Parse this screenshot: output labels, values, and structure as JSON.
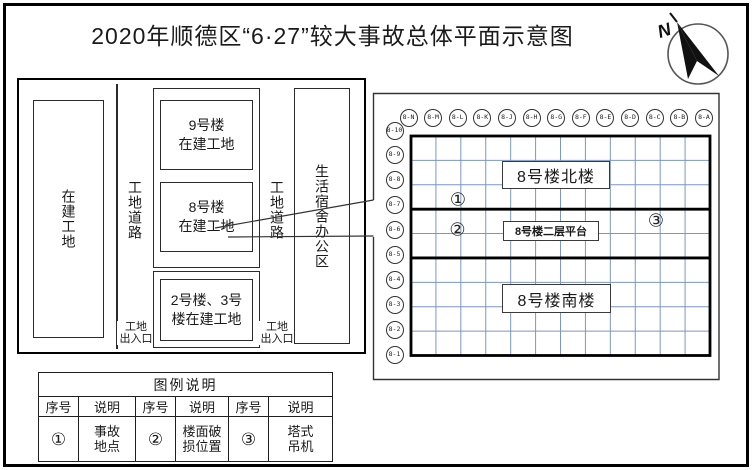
{
  "title": "2020年顺德区“6·27”较大事故总体平面示意图",
  "compass": {
    "label": "N"
  },
  "site_plan": {
    "left_area": "在建工地",
    "road_left": "工地道路",
    "road_right": "工地道路",
    "gate_left": "工地\n出入口",
    "gate_right": "工地\n出入口",
    "building9": "9号楼\n在建工地",
    "building8": "8号楼\n在建工地",
    "building23": "2号楼、3号\n楼在建工地",
    "living_area": "生活宿舍办公区"
  },
  "detail_plan": {
    "column_labels": [
      "8-N",
      "8-M",
      "8-L",
      "8-K",
      "8-J",
      "8-H",
      "8-G",
      "8-F",
      "8-E",
      "8-D",
      "8-C",
      "8-B",
      "8-A"
    ],
    "row_labels": [
      "8-10",
      "8-9",
      "8-8",
      "8-7",
      "8-6",
      "8-5",
      "8-4",
      "8-3",
      "8-2",
      "8-1"
    ],
    "north_building": "8号楼北楼",
    "platform": "8号楼二层平台",
    "south_building": "8号楼南楼",
    "markers": [
      {
        "symbol": "①"
      },
      {
        "symbol": "②"
      },
      {
        "symbol": "③"
      }
    ],
    "grid_color": "#7b96c8",
    "line_color": "#000000"
  },
  "legend": {
    "title": "图例说明",
    "header_row": [
      "序号",
      "说明",
      "序号",
      "说明",
      "序号",
      "说明"
    ],
    "value_row": [
      "①",
      "事故\n地点",
      "②",
      "楼面破\n损位置",
      "③",
      "塔式\n吊机"
    ]
  }
}
